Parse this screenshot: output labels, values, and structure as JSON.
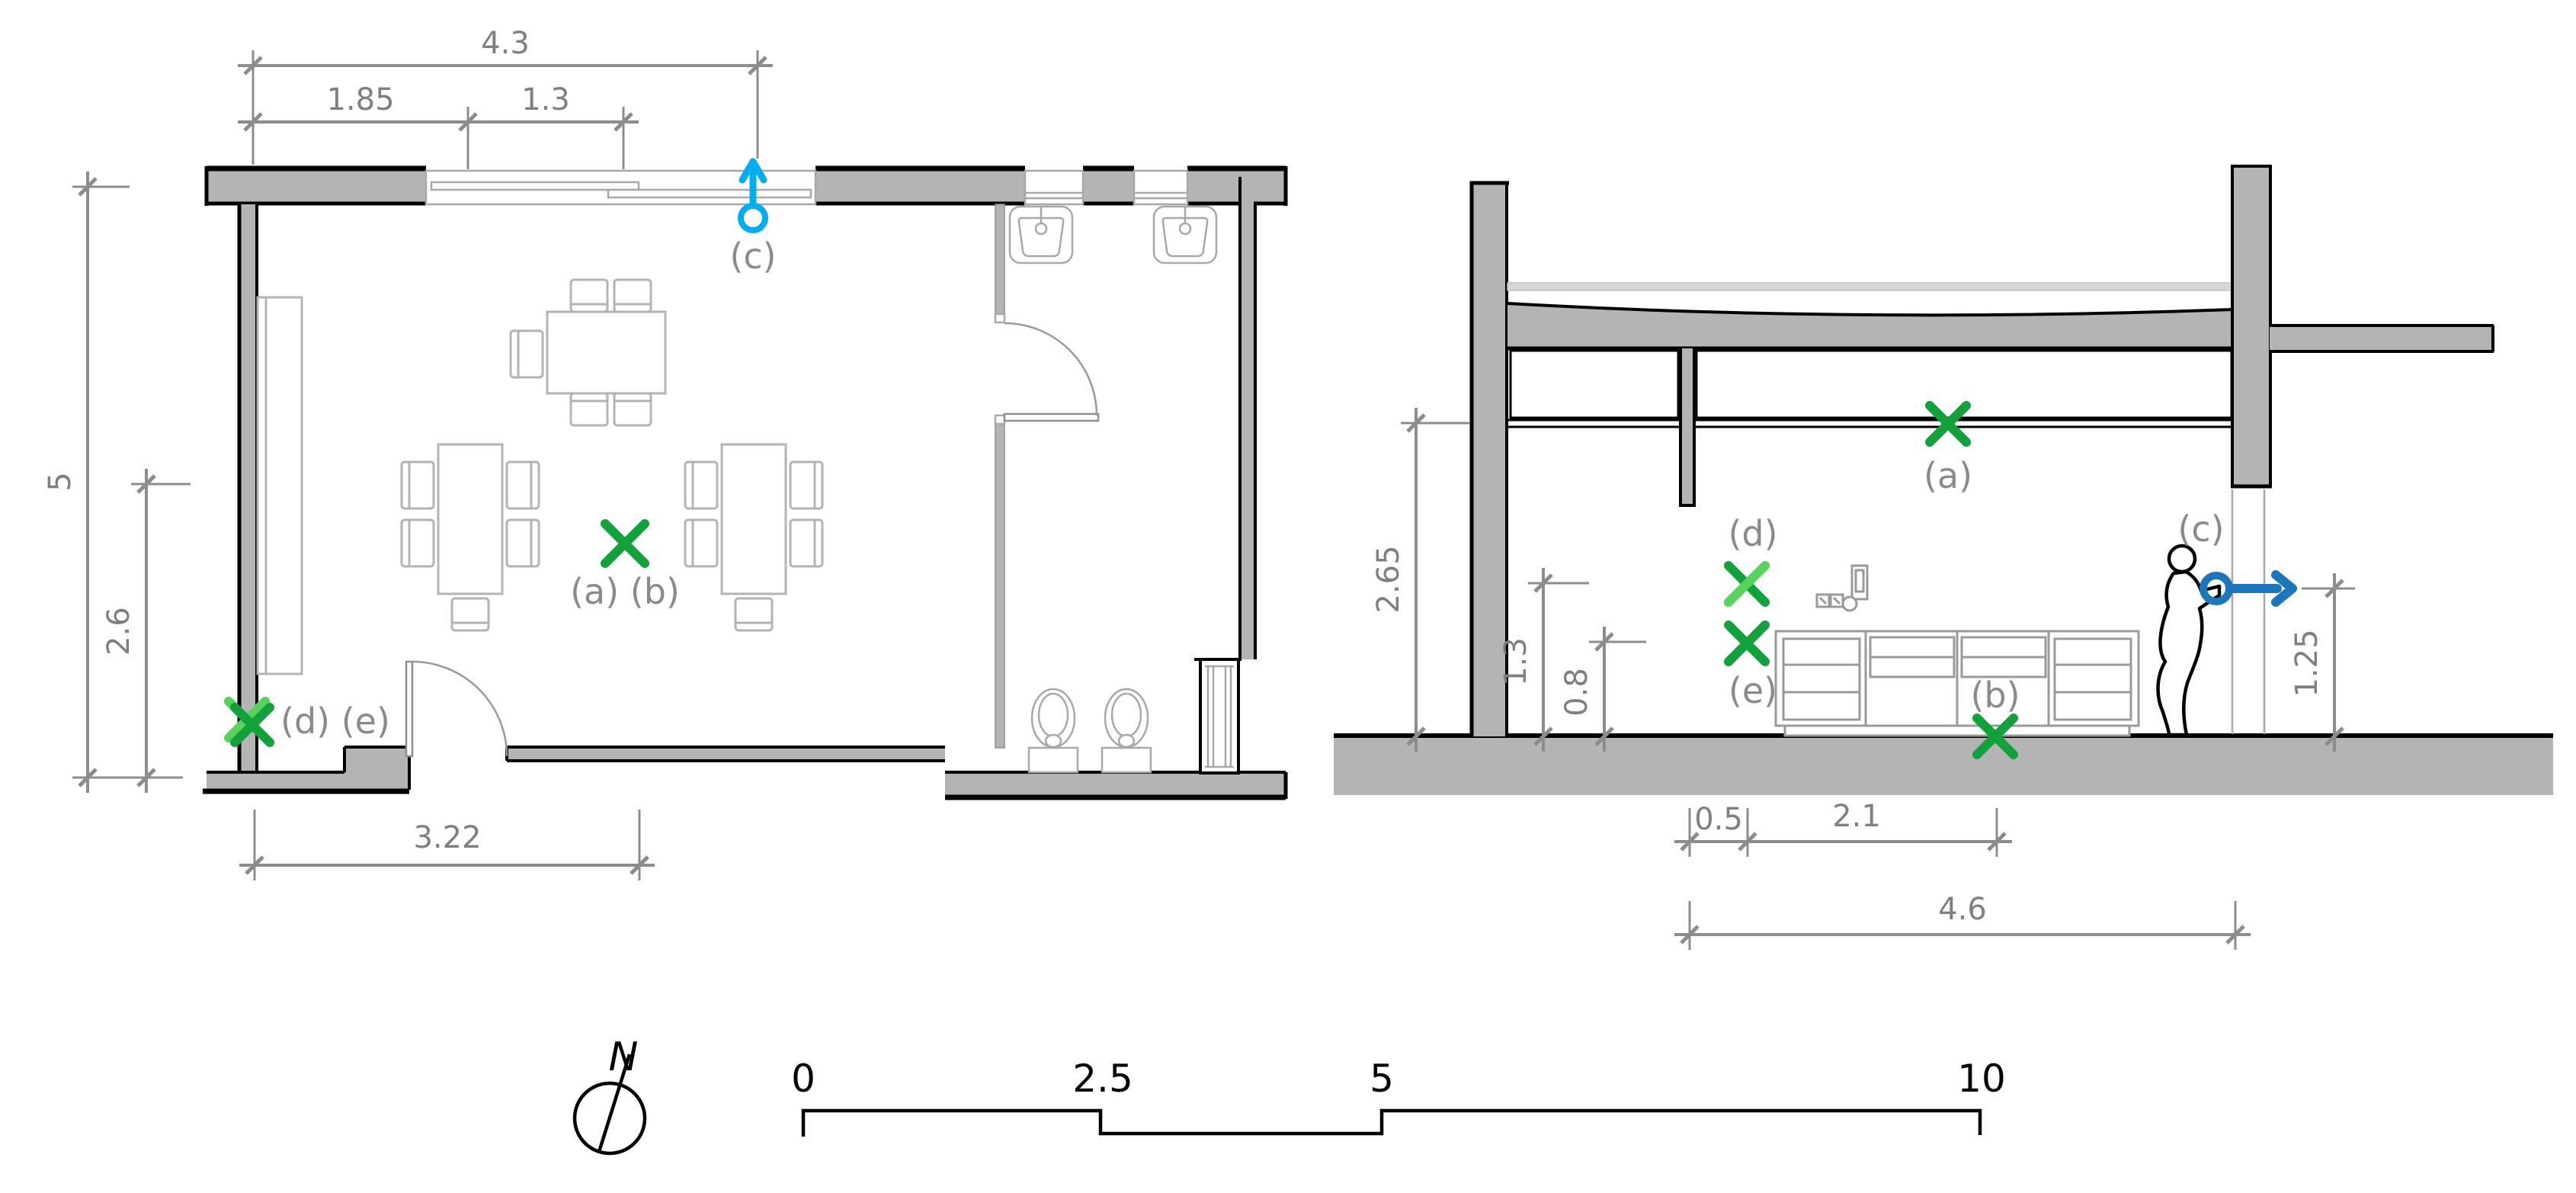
{
  "title": "architectural-plan-and-section-drawing",
  "colors": {
    "wall_gray": "#b4b4b4",
    "light_slab_gray": "#d8d8d8",
    "furniture_gray": "#b3b3b3",
    "dim_gray": "#8c8c8c",
    "label_gray": "#8a8a8a",
    "green_dark": "#12a13a",
    "green_light": "#57d35b",
    "cyan": "#00adee",
    "blue": "#1b76bc",
    "black": "#000000"
  },
  "plan": {
    "dims": {
      "top_total": "4.3",
      "top_left": "1.85",
      "top_right": "1.3",
      "left_total": "5",
      "left_inner": "2.6",
      "bottom": "3.22"
    },
    "markers": {
      "c": "(c)",
      "ab": "(a) (b)",
      "de": "(d) (e)"
    }
  },
  "section": {
    "dims": {
      "height": "2.65",
      "mid": "1.3",
      "low": "0.8",
      "right": "1.25",
      "bottom_1": "0.5",
      "bottom_2": "2.1",
      "bottom_3": "4.6"
    },
    "markers": {
      "a": "(a)",
      "b": "(b)",
      "c": "(c)",
      "d": "(d)",
      "e": "(e)"
    }
  },
  "footer": {
    "north_label": "N",
    "scale_ticks": [
      "0",
      "2.5",
      "5",
      "10"
    ]
  }
}
